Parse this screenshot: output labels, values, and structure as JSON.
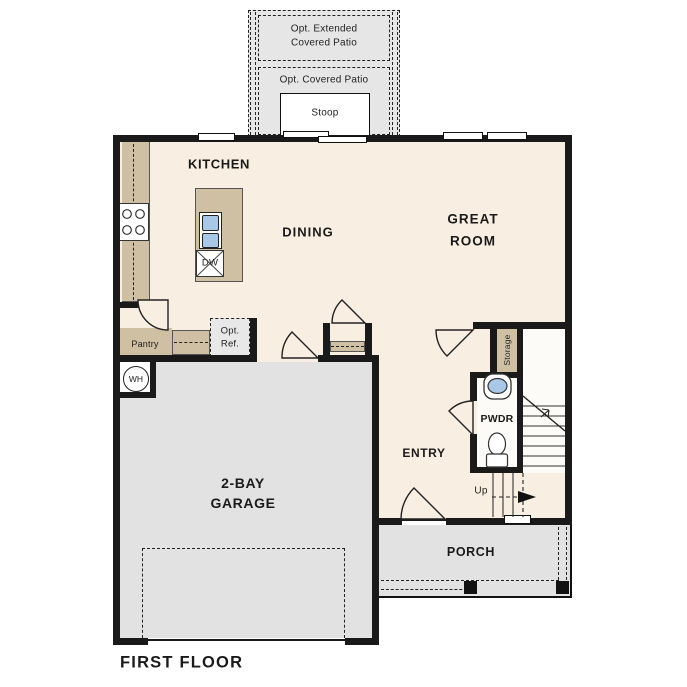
{
  "title": "FIRST FLOOR",
  "labels": {
    "kitchen": "KITCHEN",
    "dining": "DINING",
    "great_room_line1": "GREAT",
    "great_room_line2": "ROOM",
    "garage_line1": "2-BAY",
    "garage_line2": "GARAGE",
    "entry": "ENTRY",
    "pwdr": "PWDR",
    "porch": "PORCH",
    "pantry": "Pantry",
    "storage": "Storage",
    "stoop": "Stoop",
    "patio_covered": "Opt. Covered Patio",
    "patio_extended_line1": "Opt. Extended",
    "patio_extended_line2": "Covered Patio",
    "opt_ref_line1": "Opt.",
    "opt_ref_line2": "Ref.",
    "dishwasher": "DW",
    "water_heater": "WH",
    "stairs_up": "Up"
  },
  "colors": {
    "wall": "#1a1a1a",
    "floor_living": "#f8efe2",
    "floor_garage": "#e2e2e2",
    "floor_patio": "#e6e6e6",
    "counter_tan": "#cfc0a4",
    "sink_blue": "#a9c7e7",
    "line": "#333333"
  }
}
